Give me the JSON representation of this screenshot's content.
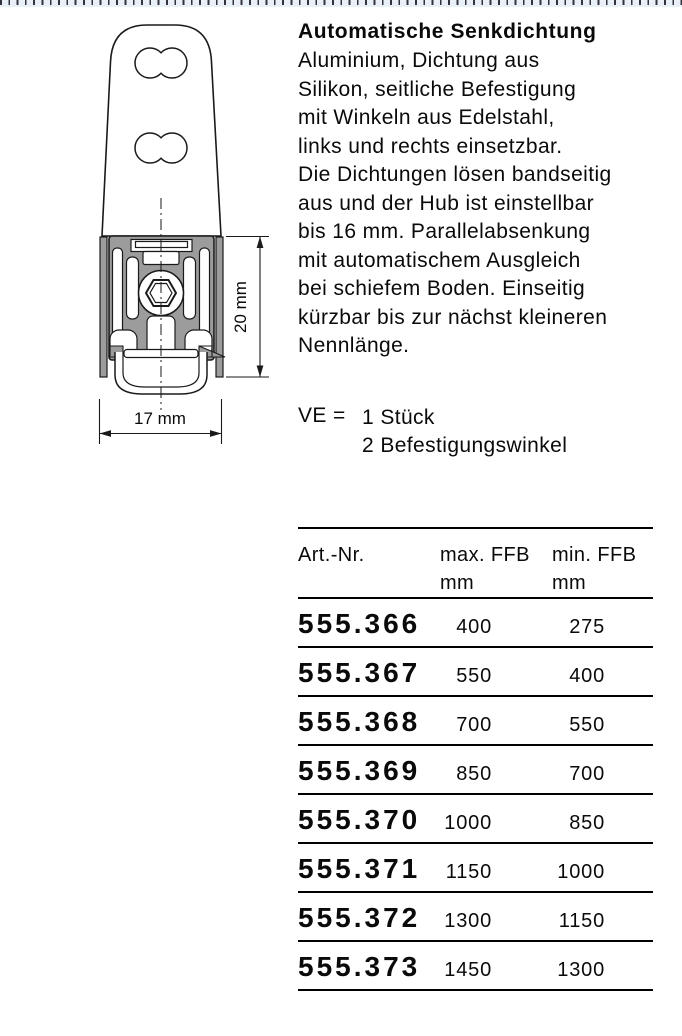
{
  "product": {
    "title": "Automatische Senkdichtung",
    "description_lines": [
      "Aluminium, Dichtung aus",
      "Silikon, seitliche Befestigung",
      "mit Winkeln aus Edelstahl,",
      "links und rechts einsetzbar.",
      "Die Dichtungen lösen bandseitig",
      "aus und der Hub ist einstellbar",
      "bis 16 mm. Parallelabsenkung",
      "mit automatischem Ausgleich",
      "bei schiefem Boden. Einseitig",
      "kürzbar bis zur nächst kleineren",
      "Nennlänge."
    ],
    "packaging": {
      "label": "VE =",
      "items": [
        "1 Stück",
        "2 Befestigungswinkel"
      ]
    }
  },
  "drawing": {
    "height_dim": "20 mm",
    "width_dim": "17 mm"
  },
  "table": {
    "columns": [
      {
        "line1": "Art.-Nr.",
        "line2": ""
      },
      {
        "line1": "max. FFB",
        "line2": "mm"
      },
      {
        "line1": "min. FFB",
        "line2": "mm"
      }
    ],
    "rows": [
      {
        "art": "555.366",
        "max": "400",
        "min": "275"
      },
      {
        "art": "555.367",
        "max": "550",
        "min": "400"
      },
      {
        "art": "555.368",
        "max": "700",
        "min": "550"
      },
      {
        "art": "555.369",
        "max": "850",
        "min": "700"
      },
      {
        "art": "555.370",
        "max": "1000",
        "min": "850"
      },
      {
        "art": "555.371",
        "max": "1150",
        "min": "1000"
      },
      {
        "art": "555.372",
        "max": "1300",
        "min": "1150"
      },
      {
        "art": "555.373",
        "max": "1450",
        "min": "1300"
      }
    ]
  },
  "colors": {
    "text": "#000000",
    "drawing_gray": "#9c9c9c",
    "ruler_background": "#eaf0f8",
    "ruler_tick": "#34343e"
  }
}
